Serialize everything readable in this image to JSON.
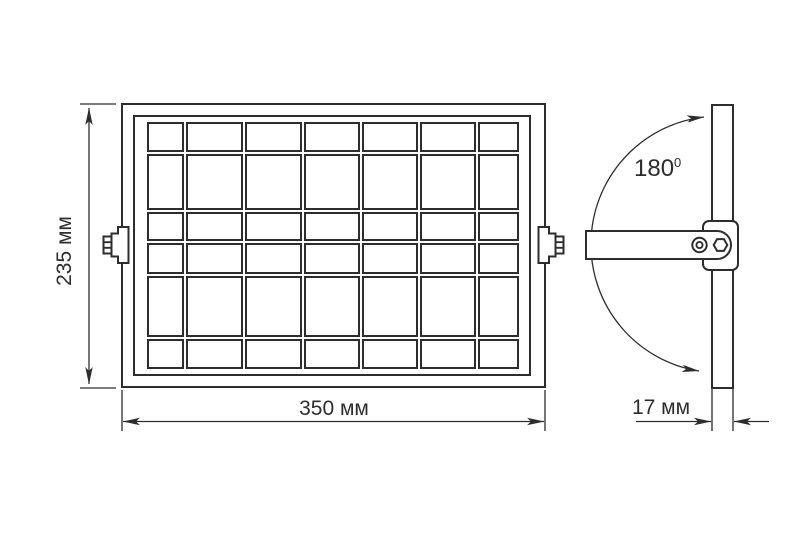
{
  "colors": {
    "line": "#2d2d2d",
    "background": "#ffffff"
  },
  "front_view": {
    "height_label": "235 мм",
    "width_label": "350 мм",
    "grid_rows": 6,
    "grid_columns": 7
  },
  "side_view": {
    "angle_value": "180",
    "angle_superscript": "0",
    "depth_label": "17 мм"
  }
}
